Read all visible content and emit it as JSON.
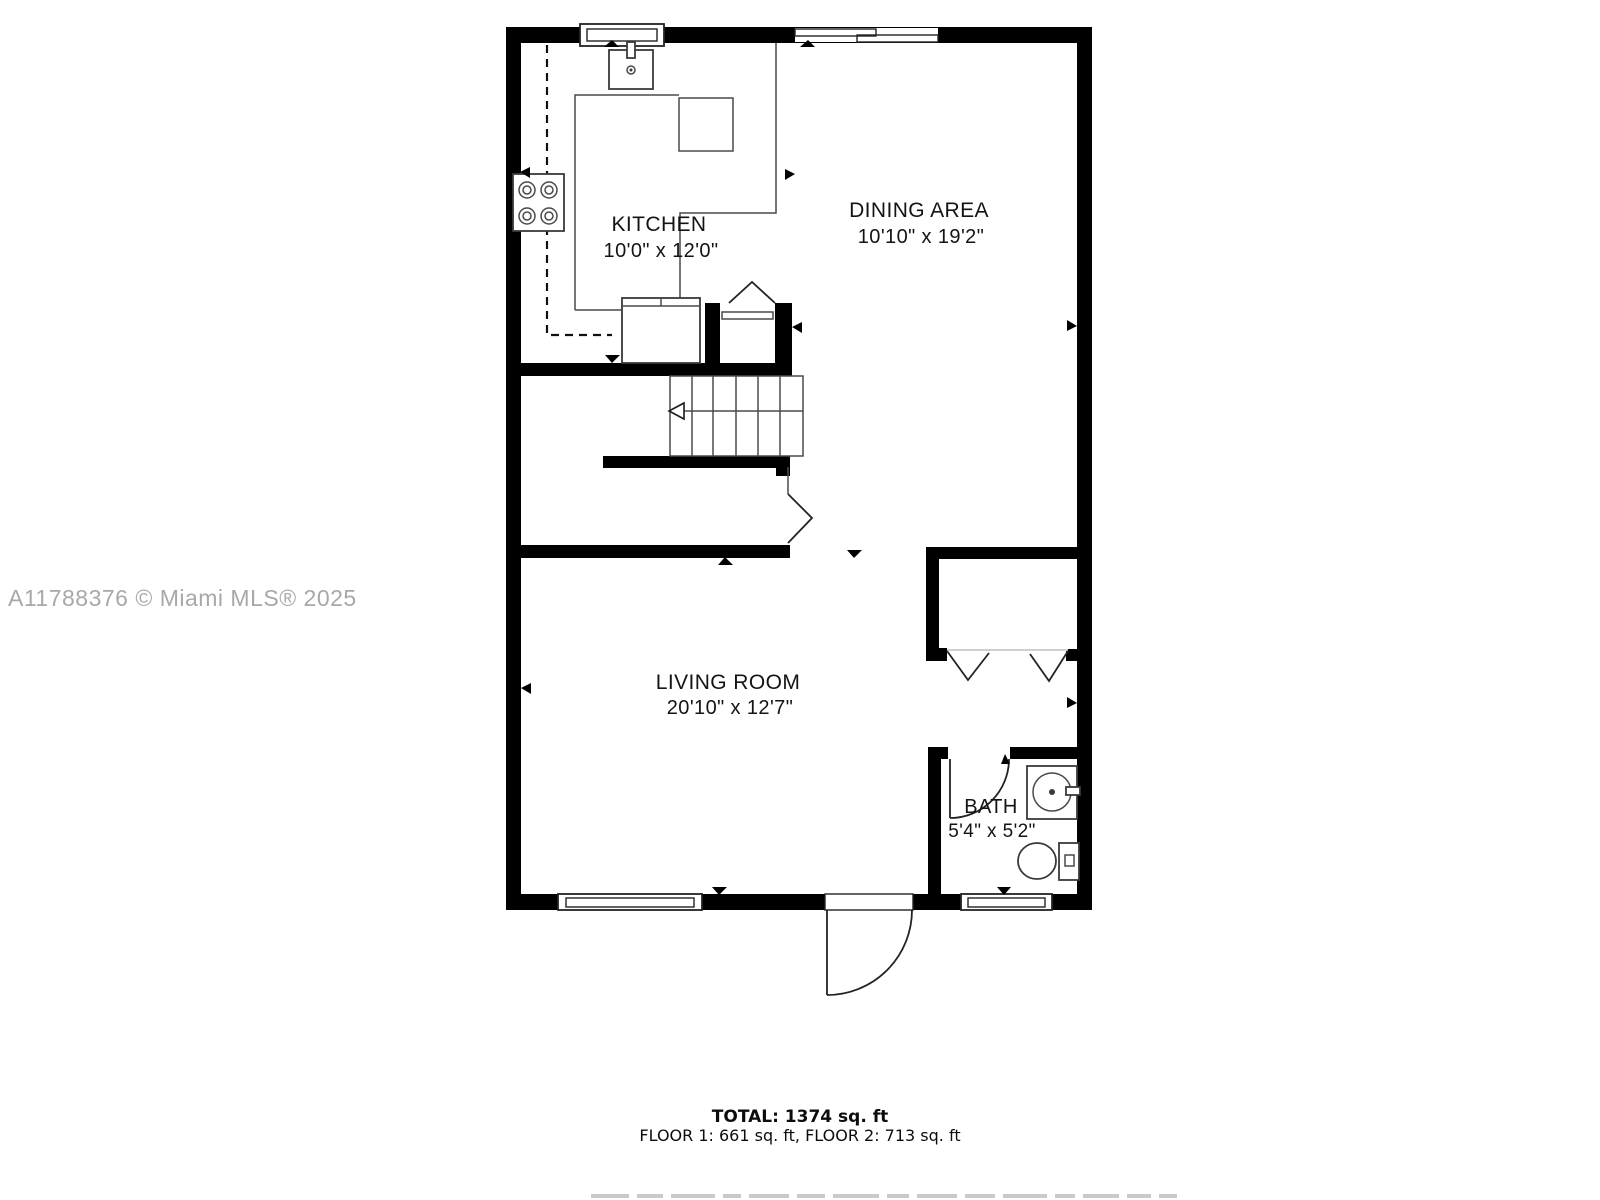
{
  "watermark": "A11788376 © Miami MLS® 2025",
  "rooms": {
    "kitchen": {
      "label": "KITCHEN",
      "dims": "10'0\" x 12'0\""
    },
    "dining": {
      "label": "DINING AREA",
      "dims": "10'10\" x 19'2\""
    },
    "living": {
      "label": "LIVING ROOM",
      "dims": "20'10\" x 12'7\""
    },
    "bath": {
      "label": "BATH",
      "dims": "5'4\" x 5'2\""
    }
  },
  "footer": {
    "total": "TOTAL: 1374 sq. ft",
    "floors": "FLOOR 1: 661 sq. ft, FLOOR 2: 713 sq. ft"
  },
  "colors": {
    "walls": "#000000",
    "thin_lines": "#3a3a3a",
    "text": "#141414",
    "watermark": "#a8a8a8"
  }
}
